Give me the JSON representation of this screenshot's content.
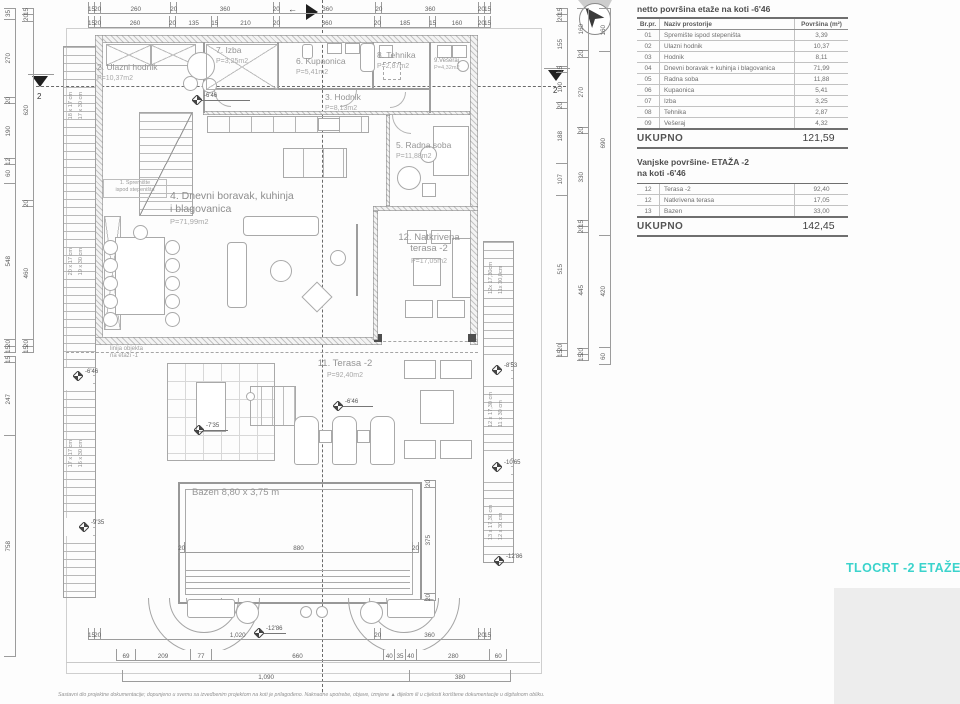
{
  "drawing": {
    "title": "TLOCRT -2 ETAŽE",
    "accent_color": "#3bd3cc"
  },
  "tables": {
    "netto": {
      "title": "netto površina etaže na koti -6'46",
      "headers": {
        "num": "Br.pr.",
        "name": "Naziv prostorije",
        "area": "Površina (m²)"
      },
      "rows": [
        {
          "num": "01",
          "name": "Spremište ispod stepeništa",
          "area": "3,39"
        },
        {
          "num": "02",
          "name": "Ulazni hodnik",
          "area": "10,37"
        },
        {
          "num": "03",
          "name": "Hodnik",
          "area": "8,11"
        },
        {
          "num": "04",
          "name": "Dnevni boravak + kuhinja i blagovanica",
          "area": "71,99"
        },
        {
          "num": "05",
          "name": "Radna soba",
          "area": "11,88"
        },
        {
          "num": "06",
          "name": "Kupaonica",
          "area": "5,41"
        },
        {
          "num": "07",
          "name": "Izba",
          "area": "3,25"
        },
        {
          "num": "08",
          "name": "Tehnika",
          "area": "2,87"
        },
        {
          "num": "09",
          "name": "Vešeraj",
          "area": "4,32"
        }
      ],
      "total_label": "UKUPNO",
      "total": "121,59"
    },
    "vanjske": {
      "title_line1": "Vanjske površine- ETAŽA -2",
      "title_line2": "na koti -6'46",
      "rows": [
        {
          "num": "12",
          "name": "Terasa -2",
          "area": "92,40"
        },
        {
          "num": "12",
          "name": "Natkrivena terasa",
          "area": "17,05"
        },
        {
          "num": "13",
          "name": "Bazen",
          "area": "33,00"
        }
      ],
      "total_label": "UKUPNO",
      "total": "142,45"
    }
  },
  "rooms": {
    "spremiste": {
      "l1": "1. Spremište",
      "l2": "ispod stepeništa"
    },
    "ulazni": {
      "label": "2. Ulazni hodnik",
      "area": "P=10,37m2"
    },
    "hodnik": {
      "label": "3. Hodnik",
      "area": "P=8,13m2"
    },
    "dnevni": {
      "l1": "4. Dnevni boravak, kuhinja",
      "l2": "i blagovanica",
      "area": "P=71,99m2"
    },
    "radna": {
      "label": "5. Radna soba",
      "area": "P=11,88m2"
    },
    "kupaonica": {
      "label": "6. Kupaonica",
      "area": "P=5,41m2"
    },
    "izba": {
      "label": "7. Izba",
      "area": "P=3,25m2"
    },
    "tehnika": {
      "label": "8. Tehnika",
      "area": "P=2,87m2"
    },
    "veseraj": {
      "label": "9.Vešeraj",
      "area": "P=4,32m2"
    },
    "terasa": {
      "label": "11. Terasa -2",
      "area": "P=92,40m2"
    },
    "natkrivena": {
      "l1": "12. Natkrivena",
      "l2": "terasa -2",
      "area": "P=17,05m2"
    },
    "bazen": {
      "label": "Bazen 8,80 x 3,75 m"
    }
  },
  "annotations": {
    "object_line1": "linija objekta",
    "object_line2": "na etaži -1"
  },
  "stairs": {
    "left_top1": "18 x 17 cm",
    "left_top2": "17 x 30 cm",
    "left_mid1": "20 x 17 cm",
    "left_mid2": "19 x 30 cm",
    "left_low1": "17 x 17 cm",
    "left_low2": "16 x 30 cm",
    "right_top1": "12x 17,30cm",
    "right_top2": "11x 30,0cm",
    "right_mid1": "12 x 17,30 cm",
    "right_mid2": "11 x 30 cm",
    "right_low1": "13 x 17,30 cm",
    "right_low2": "12 x 30 cm"
  },
  "markers": {
    "elev": {
      "entry": "-6'46",
      "terrace": "-6'46",
      "stair_left_mid": "-6'46",
      "stair_left_low": "-9'35",
      "lounge": "-7'35",
      "stair_right_top": "-8'53",
      "stair_right_mid": "-10'65",
      "stair_right_low": "-12'86",
      "bottom": "-12'86"
    },
    "section_left": "2",
    "section_right": "2",
    "section_top_arrow": "←"
  },
  "dims": {
    "top1": [
      "15",
      "20",
      "260",
      "20",
      "360",
      "20",
      "360",
      "20",
      "360",
      "20",
      "15"
    ],
    "top2": [
      "15",
      "20",
      "260",
      "20",
      "135",
      "15",
      "210",
      "20",
      "360",
      "20",
      "185",
      "15",
      "160",
      "20",
      "15"
    ],
    "left_outer": [
      "35",
      "270",
      "20",
      "190",
      "12",
      "60",
      "548",
      "20",
      "15"
    ],
    "left_inner": [
      "15",
      "20",
      "620",
      "20",
      "460",
      "20",
      "15"
    ],
    "left_lower": [
      "15",
      "247",
      "758"
    ],
    "right_inner": [
      "15",
      "20",
      "155",
      "15",
      "100",
      "20",
      "188",
      "107",
      "515",
      "20",
      "15"
    ],
    "right_mid": [
      "160",
      "20",
      "270",
      "20",
      "330",
      "15",
      "20",
      "445",
      "20",
      "15"
    ],
    "right_outer": [
      "160",
      "690",
      "420",
      "60"
    ],
    "bottom1": [
      "15",
      "20",
      "1,020",
      "20",
      "360",
      "20",
      "15"
    ],
    "bottom2": [
      "69",
      "209",
      "77",
      "660",
      "40",
      "35",
      "40",
      "280",
      "60"
    ],
    "bottom3": [
      "1,090",
      "380"
    ],
    "pool_w": [
      "20",
      "880",
      "20"
    ],
    "pool_h": [
      "20",
      "375",
      "20"
    ]
  },
  "footer": {
    "text": "Sastavni dio projektne dokumentacije; dopunjeno u svemu sa izvedbenim projektom na koti je prilagođeno. Naknadne upotrebe, objave, izmjene ▲ dijelom ili u cijelosti korištene dokumentacije u digitalnom obliku."
  }
}
